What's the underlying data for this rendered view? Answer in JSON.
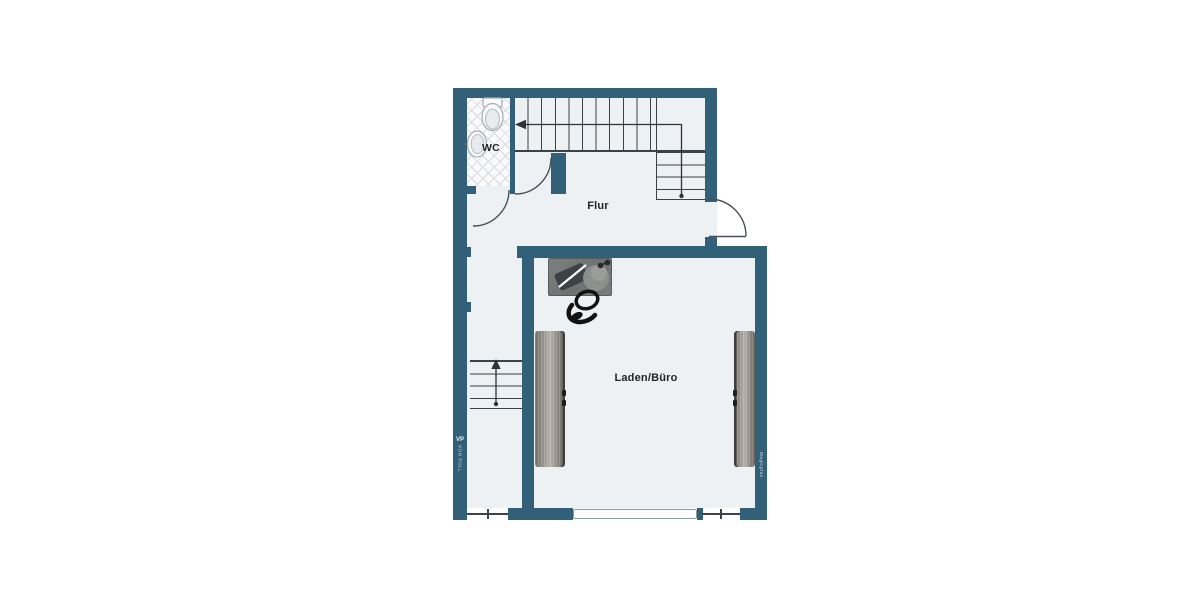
{
  "labels": {
    "wc": "WC",
    "flur": "Flur",
    "laden": "Laden/Büro"
  },
  "watermarks": {
    "left_logo": "VP",
    "left_text": "VON POLL",
    "right_text": "Magicplan"
  },
  "furniture_icons": [
    "desk-icon",
    "office-chair-icon",
    "toilet-icon",
    "sink-icon",
    "shelf-left-icon",
    "shelf-right-icon"
  ],
  "colors": {
    "wall": "#336079",
    "floor": "#edf1f4",
    "stair_line": "#3a4147",
    "wood": "#9b978f",
    "desk": "#737776",
    "tile_line": "#d7dbdf"
  }
}
